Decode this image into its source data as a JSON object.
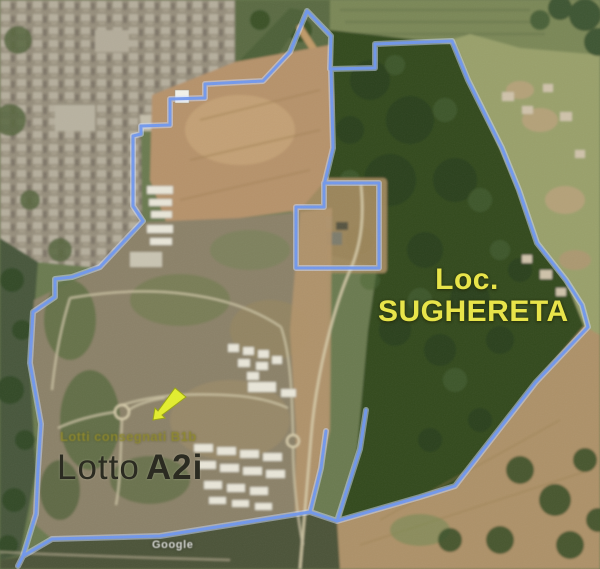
{
  "map": {
    "labels": {
      "locality_line1": "Loc.",
      "locality_line2": "SUGHERETA",
      "lot_prefix": "Lotto",
      "lot_bold": "A2i",
      "sublabel": "Lotti consegnati B1b",
      "watermark": "Google"
    },
    "colors": {
      "boundary": "#6f97ef",
      "boundary_halo": "#cddcff",
      "locality_label": "#e8e44a",
      "lot_label": "#2b2b21",
      "sublabel": "#8f892c",
      "marker": "#e3ee2d"
    }
  }
}
